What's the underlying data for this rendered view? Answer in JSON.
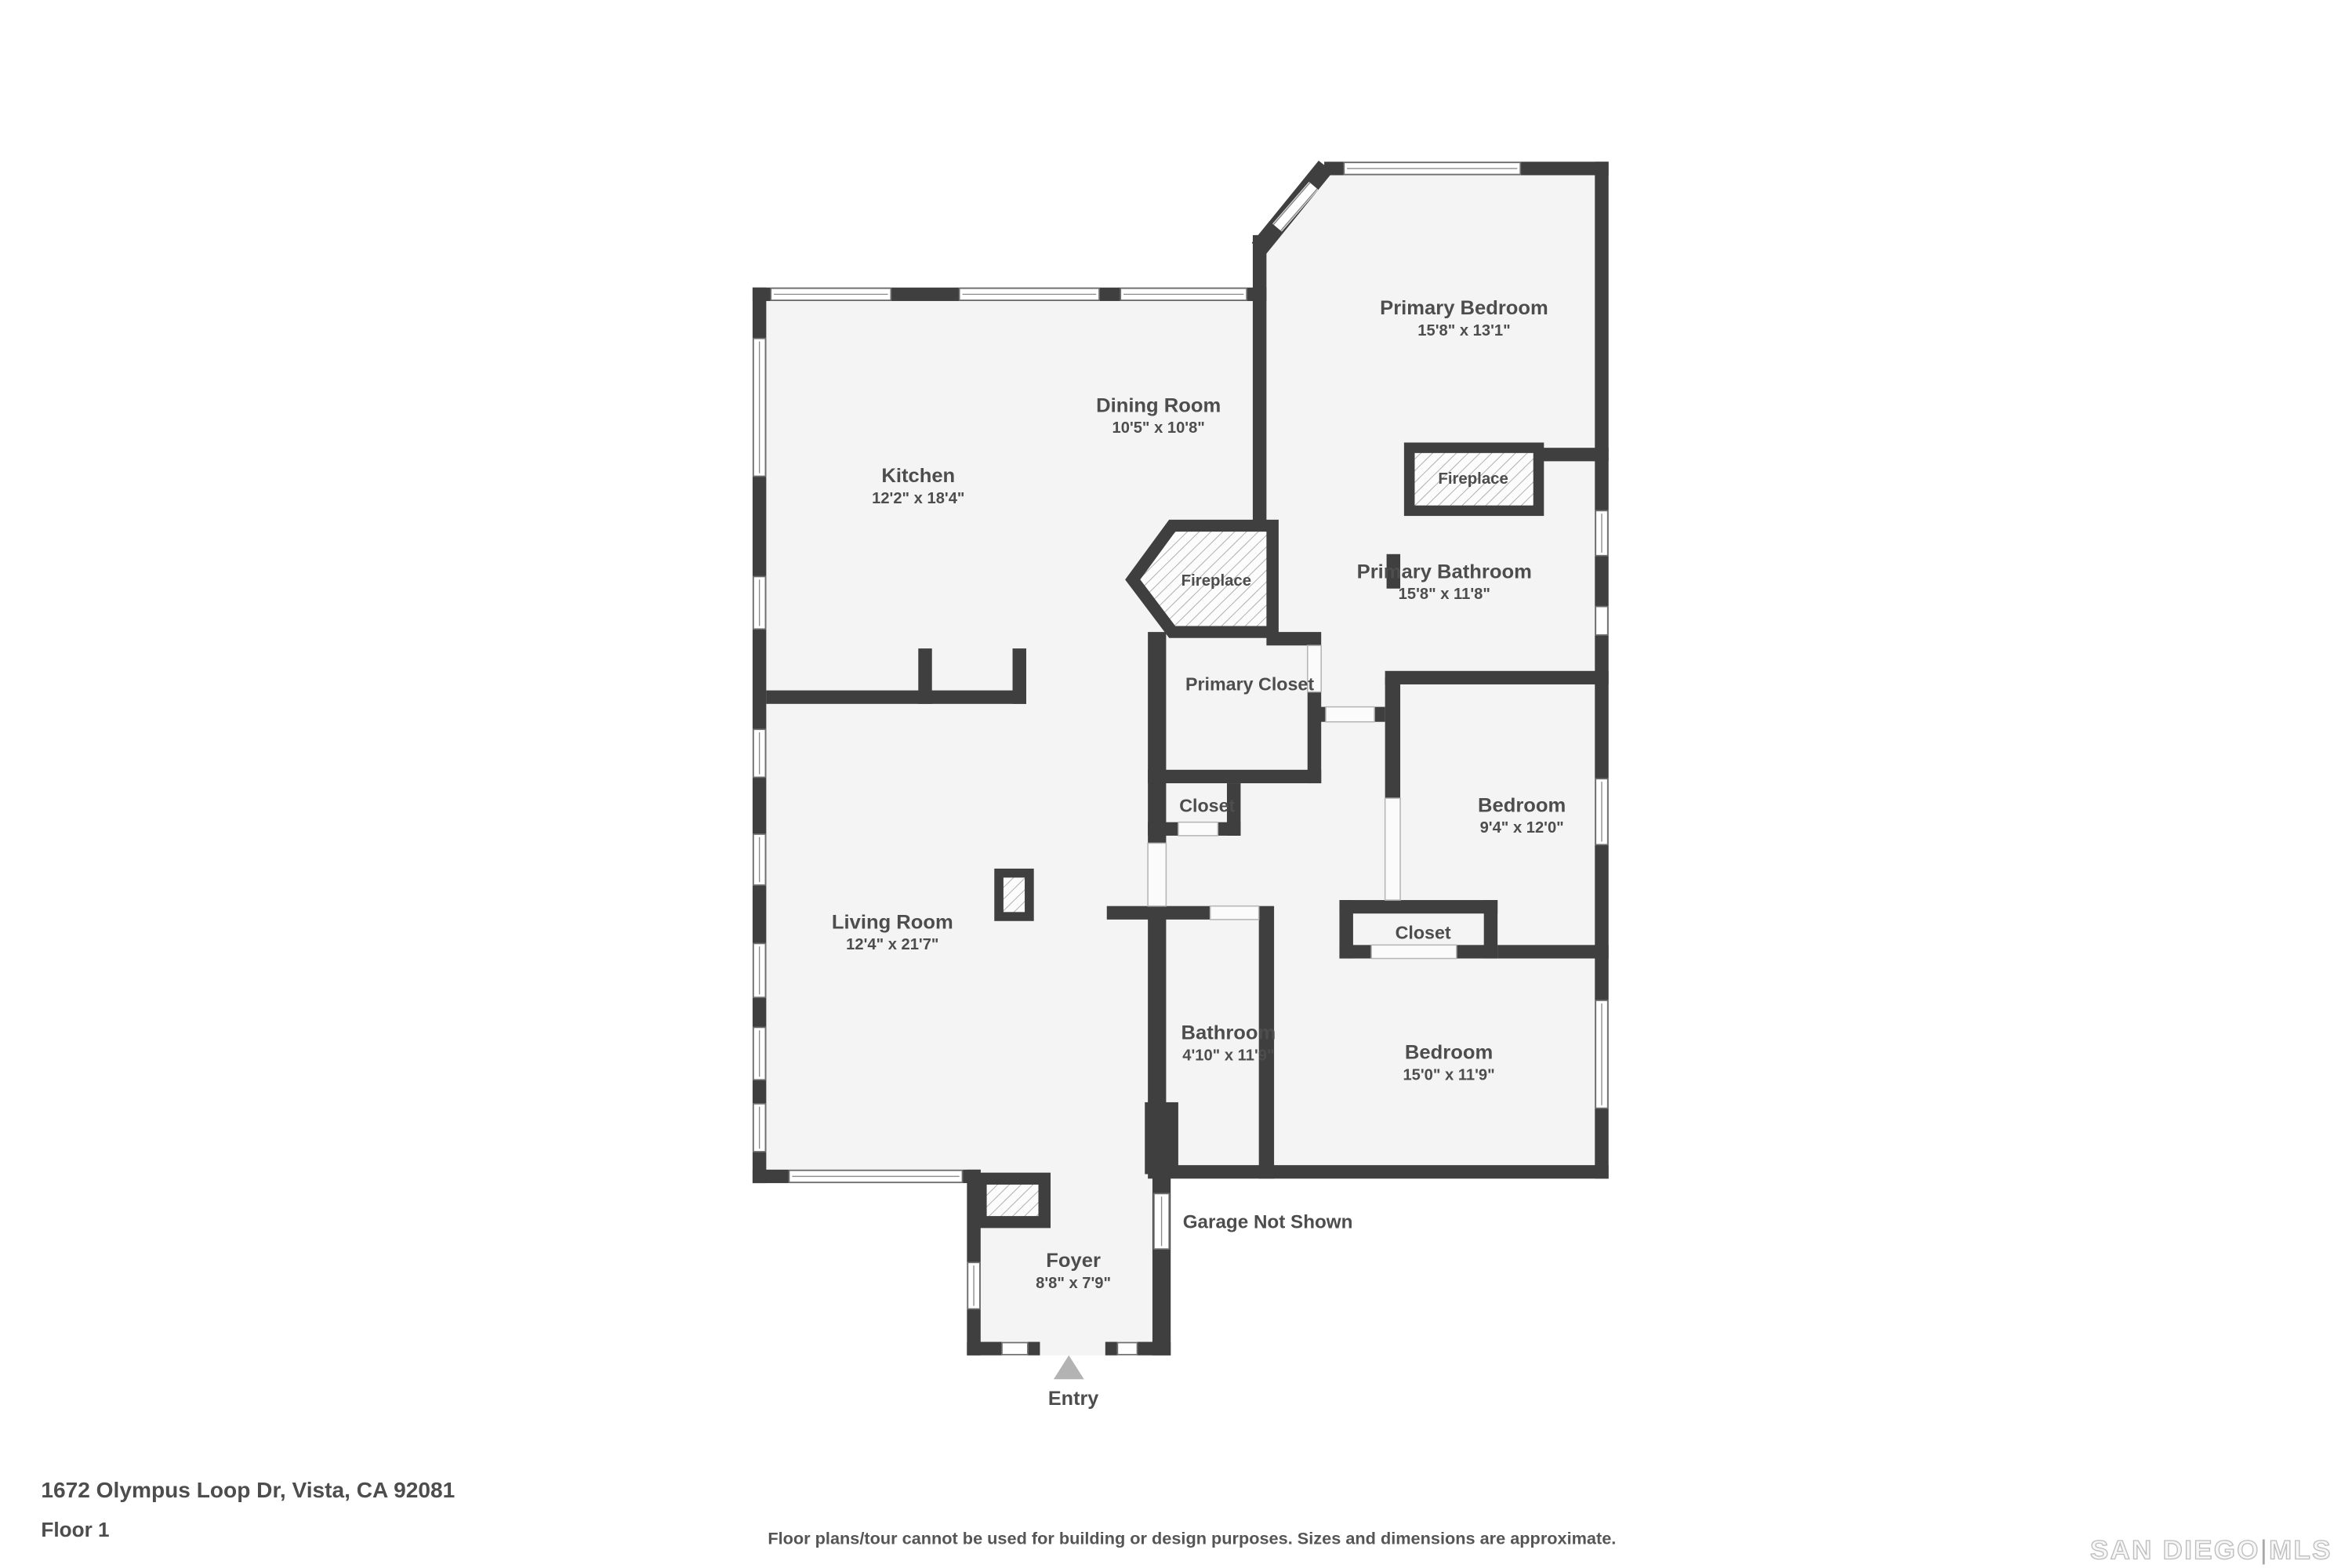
{
  "floorplan": {
    "rooms": [
      {
        "name": "Kitchen",
        "dims": "12'2\" x 18'4\""
      },
      {
        "name": "Dining Room",
        "dims": "10'5\" x 10'8\""
      },
      {
        "name": "Primary Bedroom",
        "dims": "15'8\" x 13'1\""
      },
      {
        "name": "Primary Bathroom",
        "dims": "15'8\" x 11'8\""
      },
      {
        "name": "Living Room",
        "dims": "12'4\" x 21'7\""
      },
      {
        "name": "Bedroom",
        "dims": "9'4\" x 12'0\""
      },
      {
        "name": "Bathroom",
        "dims": "4'10\" x 11'9\""
      },
      {
        "name": "Bedroom",
        "dims": "15'0\" x 11'9\""
      },
      {
        "name": "Foyer",
        "dims": "8'8\" x 7'9\""
      }
    ],
    "labels": {
      "primary_closet": "Primary Closet",
      "closet_hall": "Closet",
      "closet_bedroom": "Closet",
      "fireplace_bedroom": "Fireplace",
      "fireplace_dining": "Fireplace",
      "garage_note": "Garage Not Shown",
      "entry": "Entry"
    }
  },
  "footer": {
    "address": "1672 Olympus Loop Dr, Vista, CA 92081",
    "floor": "Floor 1",
    "disclaimer": "Floor plans/tour cannot be used for building or design purposes. Sizes and dimensions are approximate."
  },
  "watermark": {
    "brand": "SAN DIEGO",
    "divider": "|",
    "suffix": "MLS"
  },
  "colors": {
    "wall": "#3f3f3f",
    "floor": "#f4f4f5",
    "hatch_line": "#adadad",
    "text": "#4d4d4d",
    "entry_arrow": "#b3b3b3",
    "watermark": "#c9c9c9"
  }
}
